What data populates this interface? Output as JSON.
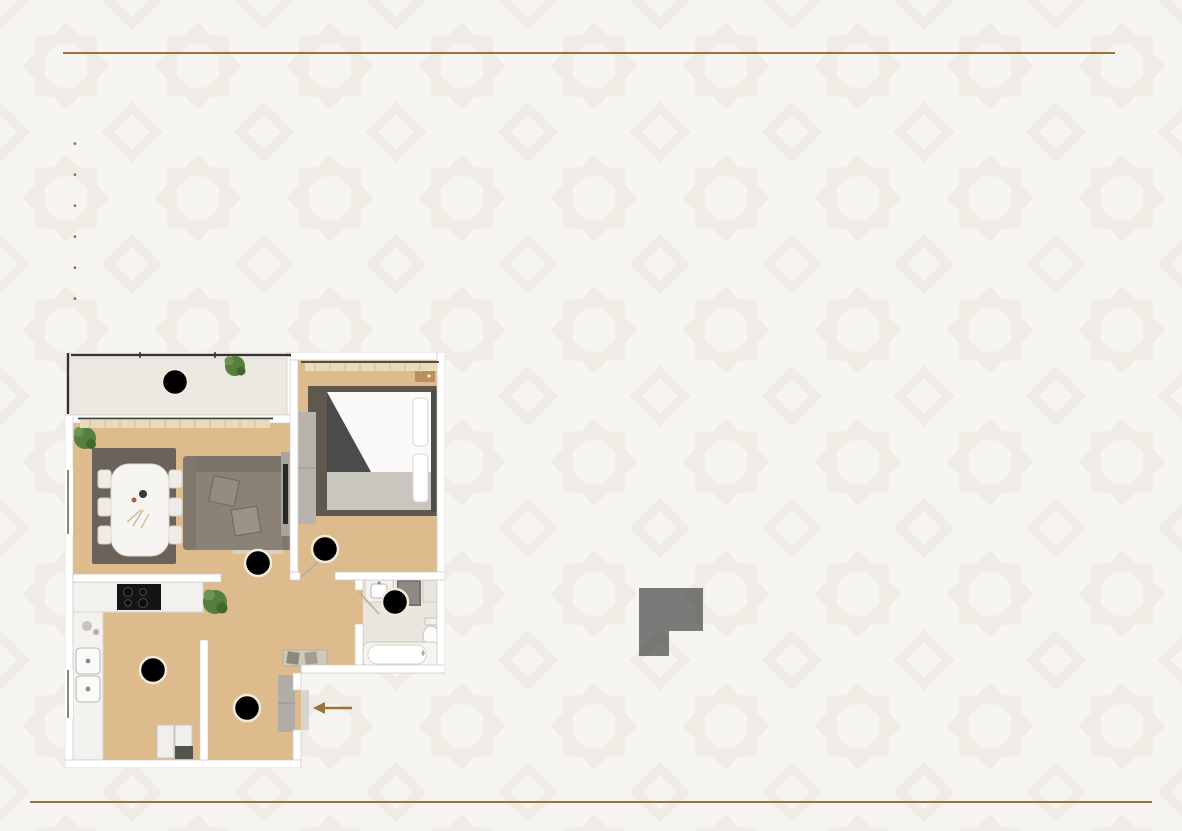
{
  "header": {
    "title": "2 комнатная квартира - 2А",
    "area": "58,1 м²"
  },
  "legend": {
    "items": [
      {
        "num": "1",
        "label": "Гостиная"
      },
      {
        "num": "2",
        "label": "Прихожая"
      },
      {
        "num": "3",
        "label": "Спальня"
      },
      {
        "num": "4",
        "label": "Кухня"
      },
      {
        "num": "5",
        "label": "Санузел"
      },
      {
        "num": "6",
        "label": "Лоджия"
      }
    ]
  },
  "colors": {
    "accent": "#9b7140",
    "badge": "#9d6b33",
    "keyplan_line": "#a1722f",
    "unit_highlight": "#b7a8a1"
  }
}
